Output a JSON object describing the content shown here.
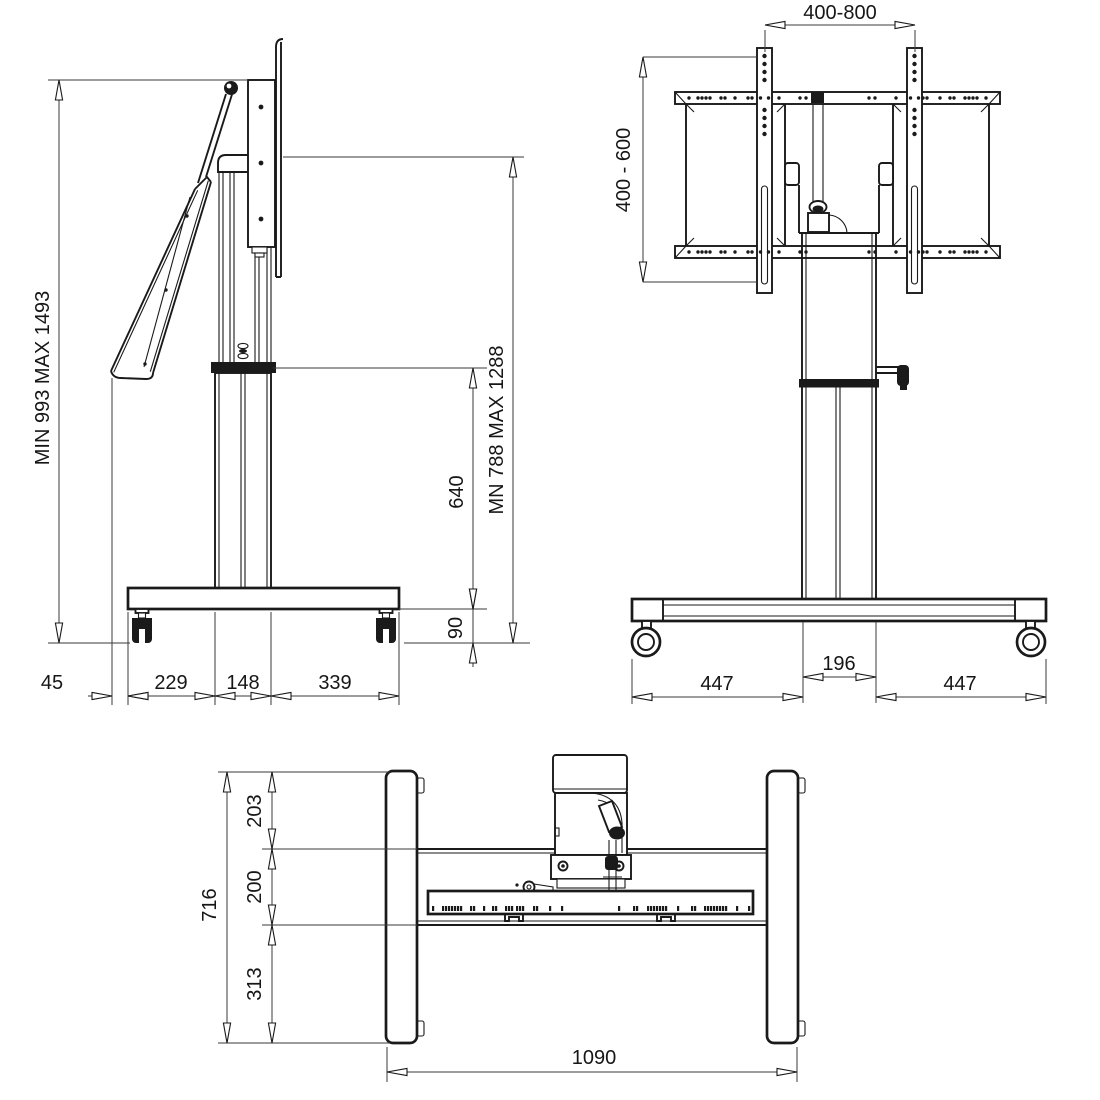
{
  "side_view": {
    "overall_height": "MIN 993 MAX 1493",
    "screen_top_height": "MN 788 MAX 1288",
    "column_height": "640",
    "base_to_floor": "90",
    "screen_overhang": "45",
    "base_rear_depth": "229",
    "column_depth": "148",
    "base_front_depth": "339"
  },
  "front_view": {
    "vesa_width_range": "400-800",
    "vesa_height_range": "400 - 600",
    "column_width": "196",
    "base_left_span": "447",
    "base_right_span": "447"
  },
  "top_view": {
    "total_depth": "716",
    "front_section": "203",
    "crossbar_depth": "200",
    "rear_section": "313",
    "overall_width": "1090"
  }
}
